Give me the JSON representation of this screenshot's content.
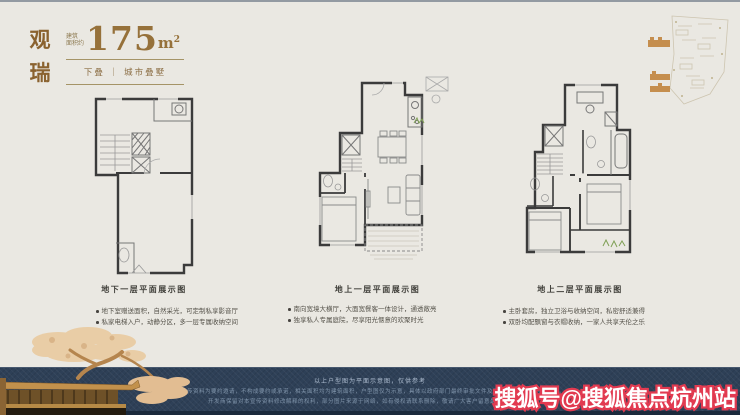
{
  "header": {
    "name_char1": "观",
    "name_char2": "瑞",
    "area_label_line1": "建筑",
    "area_label_line2": "面积约",
    "area_value": "175",
    "area_unit": "m",
    "area_sup": "2",
    "tag": "下叠 ｜ 城市叠墅"
  },
  "plans": [
    {
      "caption": "地下一层平面展示图",
      "bullets": [
        "地下室赠送面积，自然采光，可定制私享影音厅",
        "私家电梯入户，动静分区，多一层专属收纳空间"
      ]
    },
    {
      "caption": "地上一层平面展示图",
      "bullets": [
        "南向宽境大横厅，大面宽餐客一体设计，通透敞亮",
        "独享私人专属庭院，尽享阳光惬意的欢聚时光"
      ]
    },
    {
      "caption": "地上二层平面展示图",
      "bullets": [
        "主卧套房，独立卫浴与收纳空间，私密舒适兼得",
        "双卧均配飘窗与衣帽收纳，一家人共享天伦之乐"
      ]
    }
  ],
  "footer": {
    "note": "以上户型图为平面示意图，仅供参考",
    "disclaimer1": "本宣传资料为要约邀请，不构成要约或承诺，相关面积均为建筑面积，户型图仅为示意，具体以政府部门最终审批文件及商品房买卖合同约定为准。",
    "disclaimer2": "开发商保留对本宣传资料修改解释的权利，部分图片来源于网络，如有侵权请联系删除，敬请广大客户留意最新发布信息。"
  },
  "watermark": {
    "text": "搜狐号@搜狐焦点杭州站"
  },
  "colors": {
    "accent_gold": "#9a7442",
    "band_navy": "#2e4057",
    "watermark_red": "#e23a50",
    "background": "#eae8e2"
  }
}
